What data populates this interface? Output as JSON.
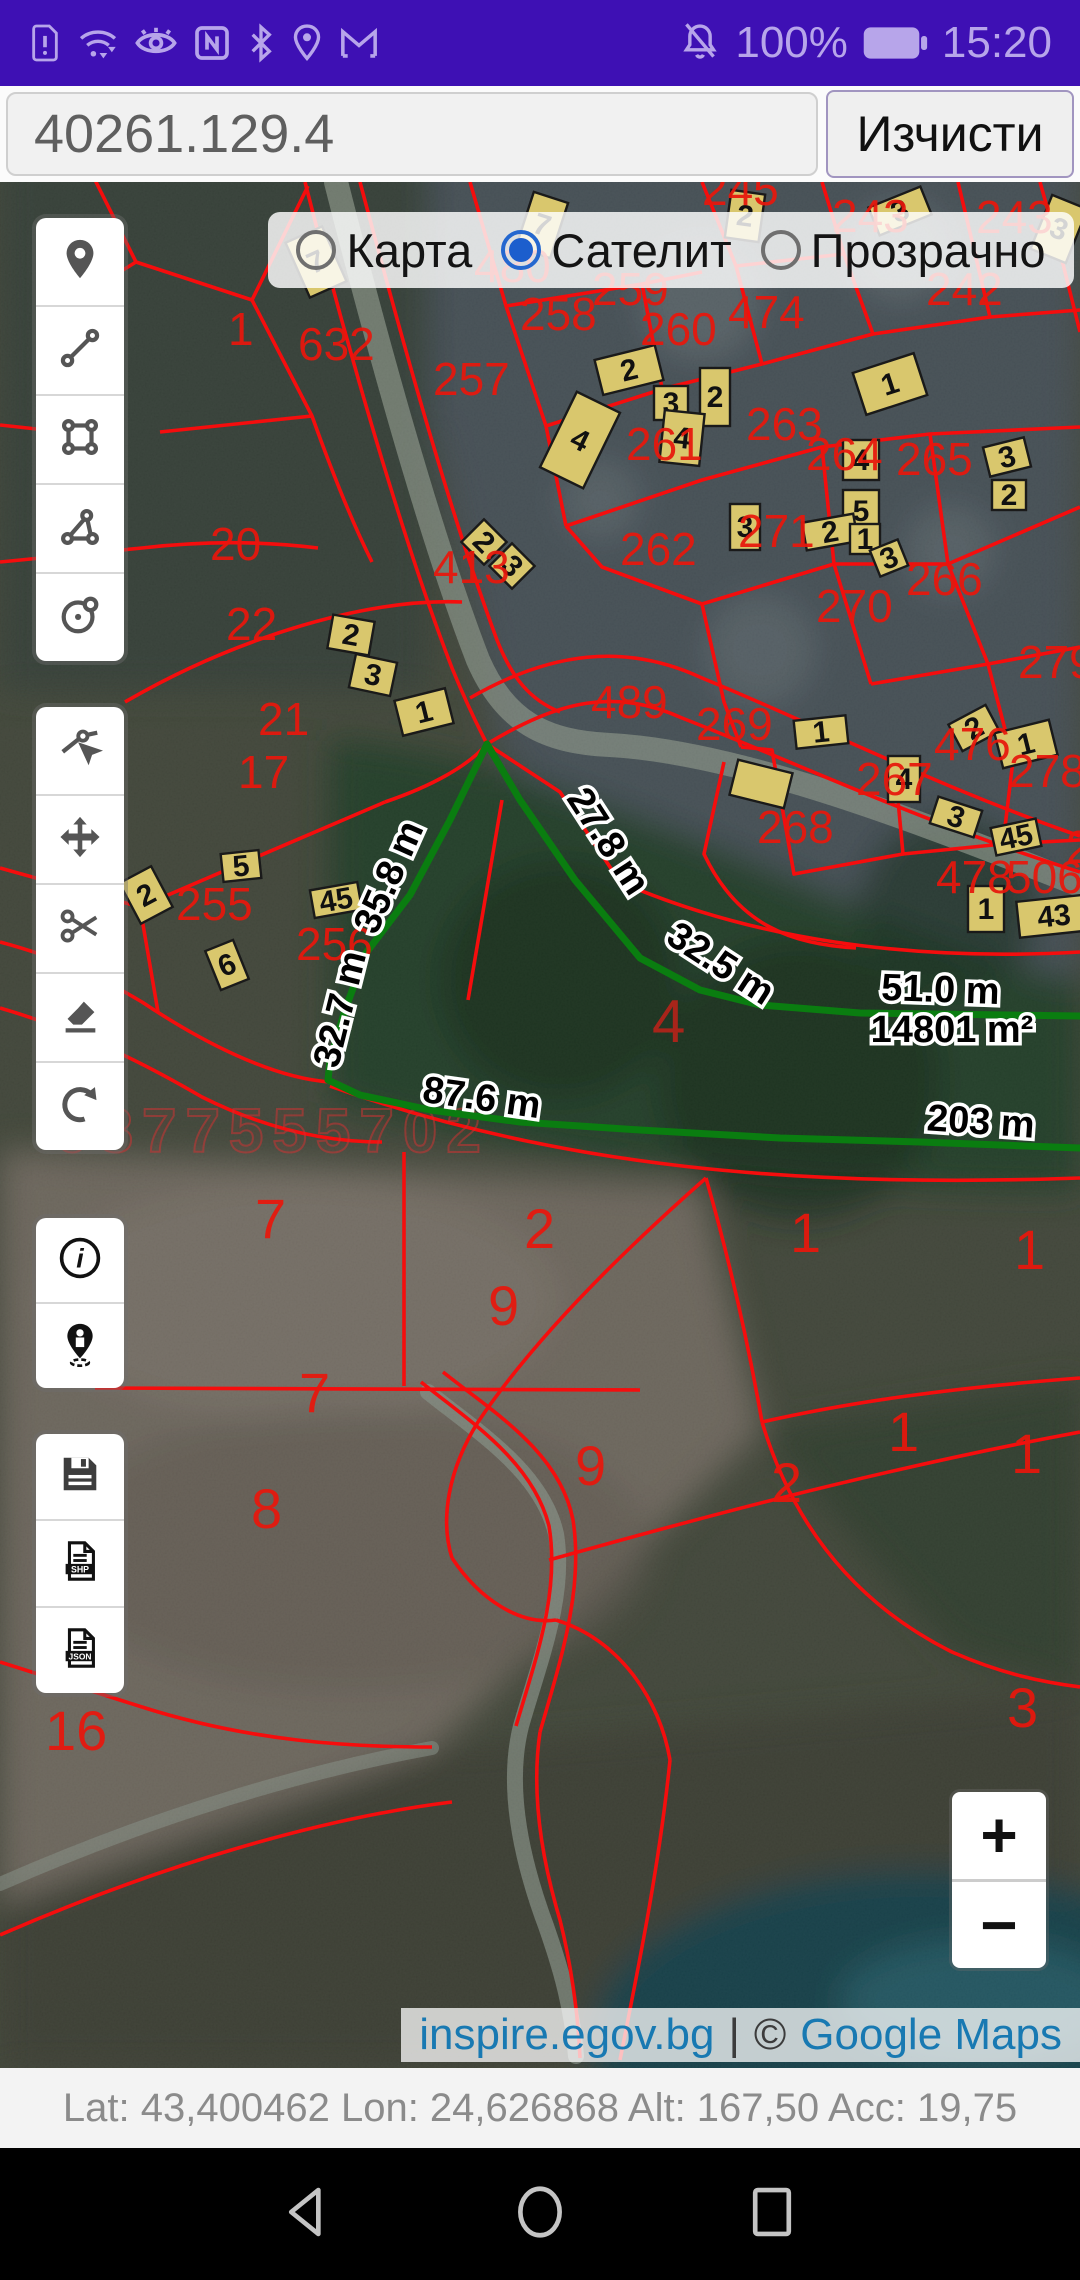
{
  "status_bar": {
    "time": "15:20",
    "battery_pct": "100%",
    "left_icons": [
      "sim-alert-icon",
      "wifi-icon",
      "eye-icon",
      "nfc-icon",
      "bluetooth-icon",
      "location-icon",
      "gmail-icon"
    ],
    "right_icons": [
      "bell-muted-icon",
      "battery-icon"
    ]
  },
  "search": {
    "value": "40261.129.4",
    "clear_label": "Изчисти"
  },
  "layer_toggle": {
    "options": [
      {
        "label": "Карта",
        "selected": false
      },
      {
        "label": "Сателит",
        "selected": true
      },
      {
        "label": "Прозрачно",
        "selected": false
      }
    ]
  },
  "toolbar": {
    "groups": [
      [
        "marker",
        "measure-line",
        "measure-rect",
        "measure-polygon",
        "measure-circle"
      ],
      [
        "edit-vertex",
        "move",
        "cut",
        "erase",
        "undo"
      ],
      [
        "info",
        "locate-person"
      ],
      [
        "save",
        "export-shp",
        "export-json"
      ]
    ],
    "shp_label": "SHP",
    "json_label": "JSON"
  },
  "zoom_control": {
    "plus": "+",
    "minus": "−"
  },
  "attribution": {
    "site": "inspire.egov.bg",
    "separator": "|",
    "copyright": "©",
    "maps": "Google Maps"
  },
  "footer": {
    "text": "Lat: 43,400462 Lon: 24,626868 Alt: 167,50 Acc: 19,75"
  },
  "map": {
    "colors": {
      "parcel_line": "#f50d0d",
      "parcel_label": "#e8170c",
      "building": "#d9c76d",
      "building_edge": "#1a1a1a",
      "measure_line": "#0a7d10",
      "field_label": "#e8170c",
      "area_label_color": "#b3241a",
      "watermark": "#cc3333"
    },
    "watermark": "0877555702",
    "measurements": {
      "area": "14801 m²",
      "segments": [
        "27.8 m",
        "32.5 m",
        "35.8 m",
        "32.7 m",
        "87.6 m",
        "51.0 m",
        "203 m"
      ],
      "parcel_no": "4"
    },
    "green_lines": [
      "487,744 520,800 575,880 640,958 700,990 760,1005 860,1013 1080,1016",
      "487,744 450,820 410,895 366,953 345,1010 330,1060 328,1080 360,1095 430,1110 520,1122 640,1130 780,1138 920,1142 1080,1148"
    ],
    "measure_labels": [
      {
        "t": "27.8 m",
        "x": 598,
        "y": 848,
        "r": 57
      },
      {
        "t": "32.5 m",
        "x": 714,
        "y": 974,
        "r": 33
      },
      {
        "t": "35.8 m",
        "x": 400,
        "y": 882,
        "r": -66
      },
      {
        "t": "32.7 m",
        "x": 352,
        "y": 1012,
        "r": -76
      },
      {
        "t": "87.6 m",
        "x": 480,
        "y": 1110,
        "r": 8
      },
      {
        "t": "51.0 m",
        "x": 940,
        "y": 1002,
        "r": 2
      },
      {
        "t": "14801 m²",
        "x": 952,
        "y": 1042,
        "r": 0
      },
      {
        "t": "203 m",
        "x": 980,
        "y": 1134,
        "r": 4
      }
    ],
    "red_lines": [
      "M305,182 C335,300 395,520 452,668 C470,712 480,730 487,744",
      "M360,182 C390,295 445,500 497,640 C512,678 530,700 560,712",
      "M487,744 C560,700 615,688 682,718 C790,760 920,822 1080,872",
      "M470,698 C550,652 625,642 702,678 C810,722 940,788 1080,836",
      "M0,152 L88,166 L136,262 L42,320",
      "M136,262 L252,300 L308,186",
      "M252,300 L312,416 C332,472 352,522 372,562",
      "M160,432 L312,416",
      "M0,425 L82,434",
      "M0,562 L142,548 C210,540 270,542 318,548",
      "M125,702 C228,642 360,598 462,602",
      "M470,182 L506,306 L546,426 L566,526",
      "M506,306 L642,284 L702,272",
      "M546,426 L666,388 L762,364",
      "M642,284 L662,388",
      "M702,182 L736,266 L762,364",
      "M822,182 L844,254 L873,334",
      "M736,266 L844,254",
      "M762,364 L873,334 L990,317 L1080,310",
      "M958,182 L990,317",
      "M1040,182 L1063,264 L1080,332",
      "M566,526 L702,480 L822,447 L930,434 L1080,427",
      "M822,447 L834,564",
      "M930,434 L948,564",
      "M834,564 L948,564",
      "M1080,507 L948,564",
      "M566,526 L602,567 L702,604 L834,564",
      "M702,604 L724,702 L741,747",
      "M834,564 L871,684",
      "M948,564 L988,664",
      "M871,684 L988,664 L1080,647",
      "M988,664 L1013,760",
      "M741,747 L772,750 L794,874 L903,854 L894,757",
      "M903,854 L1003,844 L1013,760",
      "M1003,844 L1080,840",
      "M724,762 L704,854 C738,926 792,944 856,948",
      "M620,882 C750,938 905,962 1080,952",
      "M487,744 L560,792 L620,882",
      "M385,802 C432,786 468,766 487,744",
      "M140,907 L385,802",
      "M502,800 L468,1000",
      "M140,907 L158,1012",
      "M0,868 L140,907",
      "M0,942 C60,958 102,978 142,1002 C202,1042 272,1078 330,1082",
      "M0,1008 C82,1032 142,1062 202,1097 C262,1127 322,1142 382,1142",
      "M330,1086 C560,1168 800,1188 1080,1178",
      "M95,1388 L640,1390",
      "M404,1152 L404,1386",
      "M706,1178 C615,1258 532,1342 478,1422 C448,1470 440,1520 452,1558",
      "M452,1558 C480,1600 520,1625 556,1620",
      "M706,1178 C730,1262 748,1342 762,1422",
      "M762,1422 C850,1402 950,1388 1080,1378",
      "M762,1422 C792,1522 852,1602 952,1652 C1002,1674 1042,1682 1080,1687",
      "M556,1620 C620,1640 660,1700 670,1760",
      "M421,1382 C471,1422 533,1462 549,1526 C560,1592 536,1658 516,1726",
      "M443,1372 C493,1412 560,1452 573,1520 C584,1590 560,1662 540,1732",
      "M549,1560 C650,1532 850,1475 1080,1432",
      "M540,1732 C530,1800 545,1870 560,1920 C570,1960 578,2010 580,2058",
      "M0,1662 L142,1707 C252,1742 352,1747 432,1747",
      "M0,1935 C160,1865 322,1818 452,1802",
      "M670,1760 C660,1860 640,1960 620,2060"
    ],
    "parcel_labels": [
      {
        "t": "15",
        "x": 50,
        "y": 290
      },
      {
        "t": "1",
        "x": 228,
        "y": 345
      },
      {
        "t": "632",
        "x": 298,
        "y": 360
      },
      {
        "t": "20",
        "x": 210,
        "y": 560
      },
      {
        "t": "21",
        "x": 258,
        "y": 735
      },
      {
        "t": "22",
        "x": 226,
        "y": 640
      },
      {
        "t": "17",
        "x": 238,
        "y": 788
      },
      {
        "t": "257",
        "x": 433,
        "y": 395
      },
      {
        "t": "258",
        "x": 520,
        "y": 330
      },
      {
        "t": "259",
        "x": 592,
        "y": 305
      },
      {
        "t": "260",
        "x": 640,
        "y": 345
      },
      {
        "t": "261",
        "x": 626,
        "y": 460
      },
      {
        "t": "262",
        "x": 620,
        "y": 565
      },
      {
        "t": "263",
        "x": 746,
        "y": 440
      },
      {
        "t": "264",
        "x": 806,
        "y": 470
      },
      {
        "t": "265",
        "x": 896,
        "y": 475
      },
      {
        "t": "266",
        "x": 906,
        "y": 595
      },
      {
        "t": "267",
        "x": 856,
        "y": 795
      },
      {
        "t": "268",
        "x": 757,
        "y": 843
      },
      {
        "t": "269",
        "x": 696,
        "y": 740
      },
      {
        "t": "270",
        "x": 816,
        "y": 622
      },
      {
        "t": "271",
        "x": 738,
        "y": 547
      },
      {
        "t": "243",
        "x": 832,
        "y": 232
      },
      {
        "t": "243",
        "x": 976,
        "y": 233
      },
      {
        "t": "242",
        "x": 926,
        "y": 305
      },
      {
        "t": "245",
        "x": 702,
        "y": 205
      },
      {
        "t": "474",
        "x": 728,
        "y": 328
      },
      {
        "t": "476",
        "x": 934,
        "y": 760
      },
      {
        "t": "478",
        "x": 936,
        "y": 893
      },
      {
        "t": "506",
        "x": 1006,
        "y": 893
      },
      {
        "t": "277",
        "x": 1066,
        "y": 863
      },
      {
        "t": "278",
        "x": 1009,
        "y": 787
      },
      {
        "t": "279",
        "x": 1018,
        "y": 678
      },
      {
        "t": "489",
        "x": 591,
        "y": 718
      },
      {
        "t": "413",
        "x": 433,
        "y": 583
      },
      {
        "t": "480",
        "x": 474,
        "y": 282
      },
      {
        "t": "255",
        "x": 176,
        "y": 920
      },
      {
        "t": "256",
        "x": 296,
        "y": 960
      },
      {
        "t": "7",
        "x": 255,
        "y": 1238,
        "s": 56
      },
      {
        "t": "2",
        "x": 524,
        "y": 1248,
        "s": 56
      },
      {
        "t": "1",
        "x": 790,
        "y": 1252,
        "s": 56
      },
      {
        "t": "1",
        "x": 1014,
        "y": 1269,
        "s": 56
      },
      {
        "t": "9",
        "x": 488,
        "y": 1325,
        "s": 56
      },
      {
        "t": "7",
        "x": 299,
        "y": 1412,
        "s": 56
      },
      {
        "t": "9",
        "x": 575,
        "y": 1485,
        "s": 56
      },
      {
        "t": "2",
        "x": 771,
        "y": 1502,
        "s": 56
      },
      {
        "t": "1",
        "x": 888,
        "y": 1451,
        "s": 56
      },
      {
        "t": "1",
        "x": 1011,
        "y": 1473,
        "s": 56
      },
      {
        "t": "8",
        "x": 251,
        "y": 1528,
        "s": 56
      },
      {
        "t": "16",
        "x": 45,
        "y": 1750,
        "s": 56
      },
      {
        "t": "3",
        "x": 1007,
        "y": 1727,
        "s": 56
      },
      {
        "t": "4",
        "x": 652,
        "y": 1042,
        "s": 60,
        "c": "#b3241a"
      }
    ],
    "buildings": [
      {
        "x": 728,
        "y": 192,
        "w": 34,
        "h": 48,
        "r": 8,
        "n": "2"
      },
      {
        "x": 872,
        "y": 196,
        "w": 56,
        "h": 30,
        "r": -22,
        "n": "3"
      },
      {
        "x": 524,
        "y": 196,
        "w": 36,
        "h": 58,
        "r": 18,
        "n": "7"
      },
      {
        "x": 296,
        "y": 232,
        "w": 40,
        "h": 60,
        "r": -24,
        "n": "7"
      },
      {
        "x": 556,
        "y": 398,
        "w": 48,
        "h": 84,
        "r": 26,
        "n": "4"
      },
      {
        "x": 598,
        "y": 352,
        "w": 62,
        "h": 36,
        "r": -14,
        "n": "2"
      },
      {
        "x": 654,
        "y": 386,
        "w": 34,
        "h": 34,
        "r": 0,
        "n": "3"
      },
      {
        "x": 700,
        "y": 368,
        "w": 30,
        "h": 58,
        "r": 0,
        "n": "2"
      },
      {
        "x": 662,
        "y": 412,
        "w": 40,
        "h": 52,
        "r": 6,
        "n": "4"
      },
      {
        "x": 858,
        "y": 362,
        "w": 64,
        "h": 44,
        "r": -18,
        "n": "1"
      },
      {
        "x": 843,
        "y": 440,
        "w": 36,
        "h": 40,
        "r": 0,
        "n": "4"
      },
      {
        "x": 843,
        "y": 490,
        "w": 36,
        "h": 42,
        "r": 0,
        "n": "5"
      },
      {
        "x": 730,
        "y": 504,
        "w": 30,
        "h": 46,
        "r": 0,
        "n": "3"
      },
      {
        "x": 986,
        "y": 442,
        "w": 42,
        "h": 30,
        "r": -14,
        "n": "3"
      },
      {
        "x": 992,
        "y": 480,
        "w": 34,
        "h": 30,
        "r": 0,
        "n": "2"
      },
      {
        "x": 804,
        "y": 518,
        "w": 52,
        "h": 28,
        "r": -10,
        "n": "2"
      },
      {
        "x": 850,
        "y": 524,
        "w": 30,
        "h": 30,
        "r": 0,
        "n": "1"
      },
      {
        "x": 874,
        "y": 544,
        "w": 30,
        "h": 28,
        "r": -22,
        "n": "3"
      },
      {
        "x": 1040,
        "y": 200,
        "w": 38,
        "h": 58,
        "r": 22,
        "n": "3"
      },
      {
        "x": 468,
        "y": 526,
        "w": 32,
        "h": 32,
        "r": 45,
        "n": "2"
      },
      {
        "x": 496,
        "y": 550,
        "w": 32,
        "h": 32,
        "r": 45,
        "n": "3"
      },
      {
        "x": 330,
        "y": 618,
        "w": 42,
        "h": 34,
        "r": 10,
        "n": "2"
      },
      {
        "x": 352,
        "y": 658,
        "w": 42,
        "h": 34,
        "r": 12,
        "n": "3"
      },
      {
        "x": 398,
        "y": 694,
        "w": 52,
        "h": 36,
        "r": -14,
        "n": "1"
      },
      {
        "x": 222,
        "y": 852,
        "w": 38,
        "h": 28,
        "r": -6,
        "n": "5"
      },
      {
        "x": 312,
        "y": 886,
        "w": 48,
        "h": 28,
        "r": -10,
        "n": "45"
      },
      {
        "x": 212,
        "y": 944,
        "w": 30,
        "h": 42,
        "r": -22,
        "n": "6"
      },
      {
        "x": 128,
        "y": 872,
        "w": 36,
        "h": 46,
        "r": -28,
        "n": "2"
      },
      {
        "x": 795,
        "y": 718,
        "w": 52,
        "h": 28,
        "r": -6,
        "n": "1"
      },
      {
        "x": 733,
        "y": 766,
        "w": 56,
        "h": 36,
        "r": 14,
        "n": ""
      },
      {
        "x": 888,
        "y": 756,
        "w": 32,
        "h": 46,
        "r": 0,
        "n": "4"
      },
      {
        "x": 933,
        "y": 803,
        "w": 46,
        "h": 28,
        "r": 18,
        "n": "3"
      },
      {
        "x": 993,
        "y": 823,
        "w": 46,
        "h": 28,
        "r": -12,
        "n": "45"
      },
      {
        "x": 968,
        "y": 886,
        "w": 36,
        "h": 46,
        "r": 0,
        "n": "1"
      },
      {
        "x": 1018,
        "y": 898,
        "w": 72,
        "h": 36,
        "r": -6,
        "n": "43"
      },
      {
        "x": 953,
        "y": 713,
        "w": 42,
        "h": 30,
        "r": -28,
        "n": "2"
      },
      {
        "x": 998,
        "y": 726,
        "w": 56,
        "h": 36,
        "r": -14,
        "n": "1"
      }
    ]
  },
  "nav_bar": {
    "icons": [
      "back-icon",
      "home-icon",
      "recents-icon"
    ]
  }
}
